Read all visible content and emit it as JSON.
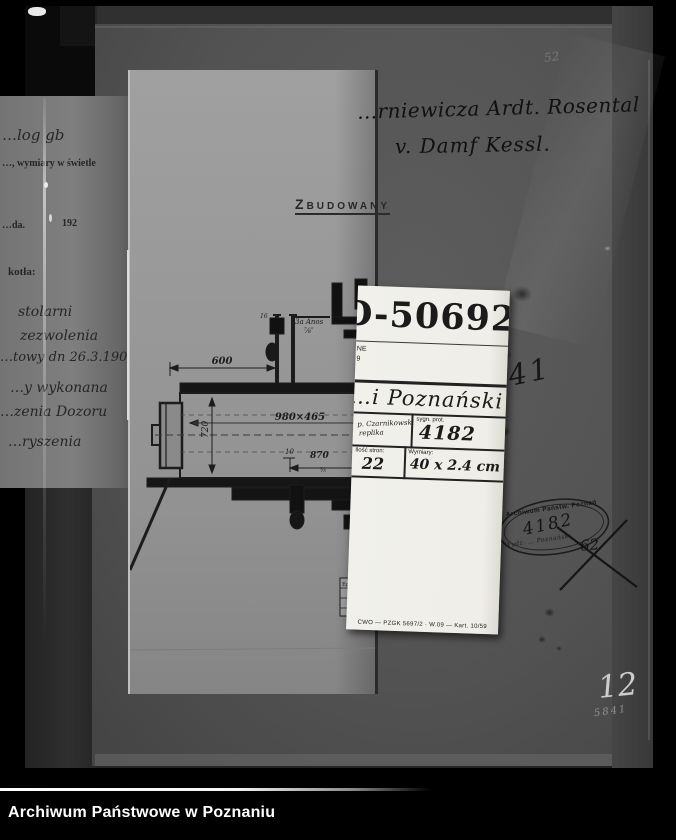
{
  "caption": {
    "title": "Archiwum Państwowe w Poznaniu"
  },
  "ledger": {
    "lines": [
      "…log gb",
      "…, wymiary w świetle",
      "…da.",
      "192",
      "kotła:",
      "stolarni",
      "zezwolenia",
      "…towy dn 26.3.1907 r.",
      "…y wykonana",
      "…zenia Dozoru",
      "…ryszenia"
    ]
  },
  "sheet": {
    "built_stamp": "ZBUDOWANY"
  },
  "drawing": {
    "d600": "600",
    "anchor1": "3a Anos",
    "anchor2": "⅞″",
    "d16": "16",
    "main_dim": "980×465",
    "d720": "720",
    "d10": "10",
    "d870": "870",
    "frac": "⅝",
    "egz": "Egz."
  },
  "right_panel": {
    "note_line1": "…rniewicza Ardt. Rosental",
    "note_line2": "v. Damf Kessl.",
    "corner_mark": "52",
    "number_841": "841",
    "crossed_number": "62",
    "pencil_big": "12",
    "pencil_small": "5841"
  },
  "oval_stamp": {
    "top": "Archiwum Państw. Poznań",
    "number": "4182",
    "bottom": "Wydz. …  Poznański"
  },
  "card": {
    "big_number": "D-50692",
    "fragment1": "NE",
    "fragment2": "9",
    "line_poznanski": "…i Poznański",
    "cell1_line1": "p. Czarnikowski",
    "cell1_line2": "replika",
    "cell2_header": "sygn. prot.",
    "cell2_value": "4182",
    "cell3_header": "Ilość stron:",
    "cell3_value": "22",
    "cell4_header": "Wymiary:",
    "cell4_value": "40 x 2.4 cm",
    "footer": "CWO — PZGK 5697/2 · W.09 — Kart. 10/59"
  },
  "colors": {
    "ink": "#1b1b1b",
    "pencil": "#cdcdcd",
    "card_bg": "#f1f0ea"
  }
}
